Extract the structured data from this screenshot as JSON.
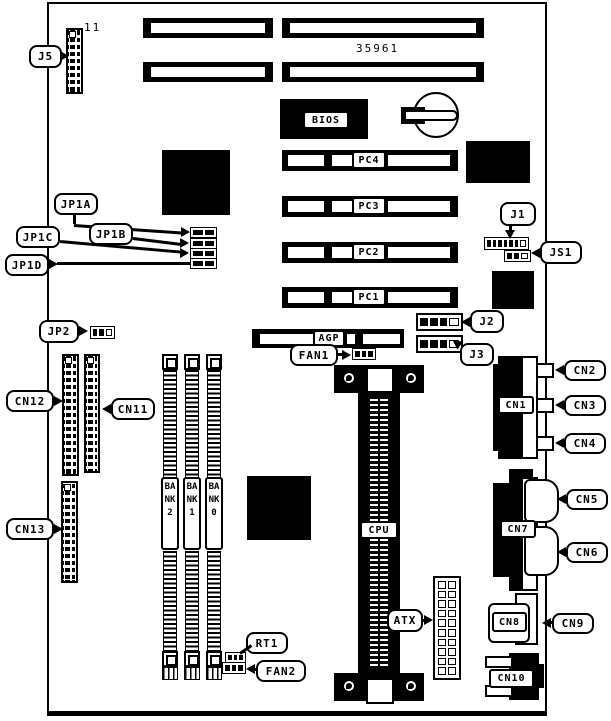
{
  "diagram": {
    "part_number": "35961",
    "pin1_label": "11",
    "bios_label": "BIOS",
    "agp_label": "AGP",
    "cpu_label": "CPU",
    "atx_label": "ATX",
    "rt1_label": "RT1",
    "pci_slots": [
      "PC4",
      "PC3",
      "PC2",
      "PC1"
    ],
    "memory_banks": [
      "BANK2",
      "BANK1",
      "BANK0"
    ],
    "jumpers": {
      "j5": "J5",
      "j1": "J1",
      "j2": "J2",
      "j3": "J3",
      "js1": "JS1",
      "jp1a": "JP1A",
      "jp1b": "JP1B",
      "jp1c": "JP1C",
      "jp1d": "JP1D",
      "jp2": "JP2"
    },
    "fans": {
      "fan1": "FAN1",
      "fan2": "FAN2"
    },
    "connectors": {
      "cn1": "CN1",
      "cn2": "CN2",
      "cn3": "CN3",
      "cn4": "CN4",
      "cn5": "CN5",
      "cn6": "CN6",
      "cn7": "CN7",
      "cn8": "CN8",
      "cn9": "CN9",
      "cn10": "CN10",
      "cn11": "CN11",
      "cn12": "CN12",
      "cn13": "CN13"
    }
  }
}
